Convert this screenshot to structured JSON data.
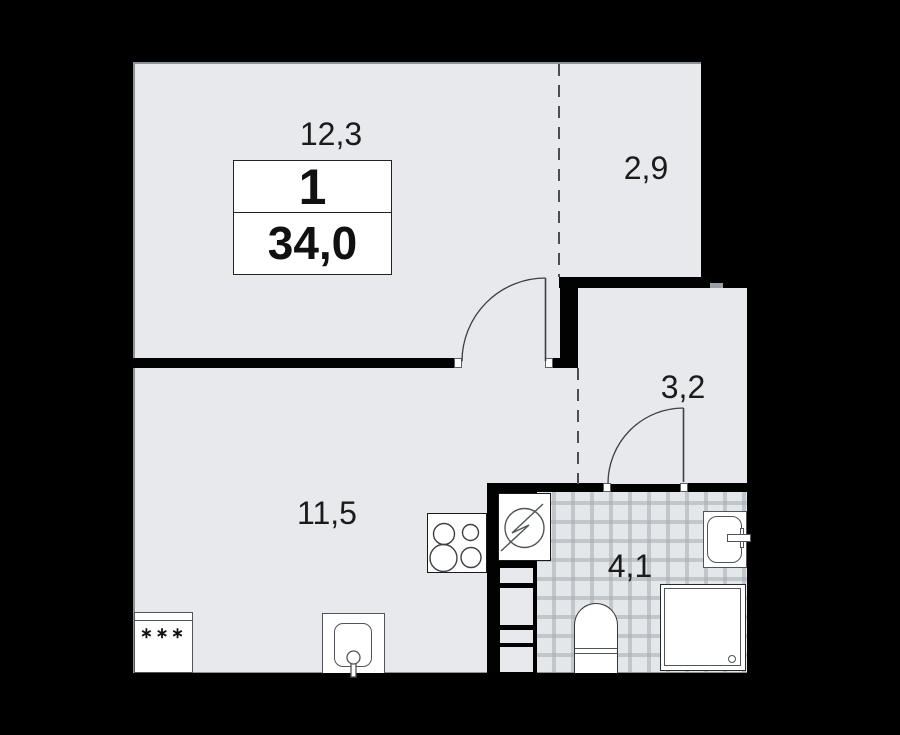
{
  "plan": {
    "unit_info": {
      "rooms_count": "1",
      "total_area": "34,0"
    },
    "rooms": [
      {
        "id": "living-room",
        "area_label": "12,3"
      },
      {
        "id": "balcony",
        "area_label": "2,9"
      },
      {
        "id": "hallway",
        "area_label": "3,2"
      },
      {
        "id": "kitchen-living",
        "area_label": "11,5"
      },
      {
        "id": "bathroom",
        "area_label": "4,1"
      }
    ],
    "fixtures": {
      "fridge_marks": "∗∗∗"
    },
    "colors": {
      "background": "#000000",
      "floor": "#e7e9ec",
      "wall": "#020202",
      "tile_floor": "#e4e7ea",
      "tile_line": "#cfd4d8",
      "outline": "#3c4043"
    }
  }
}
